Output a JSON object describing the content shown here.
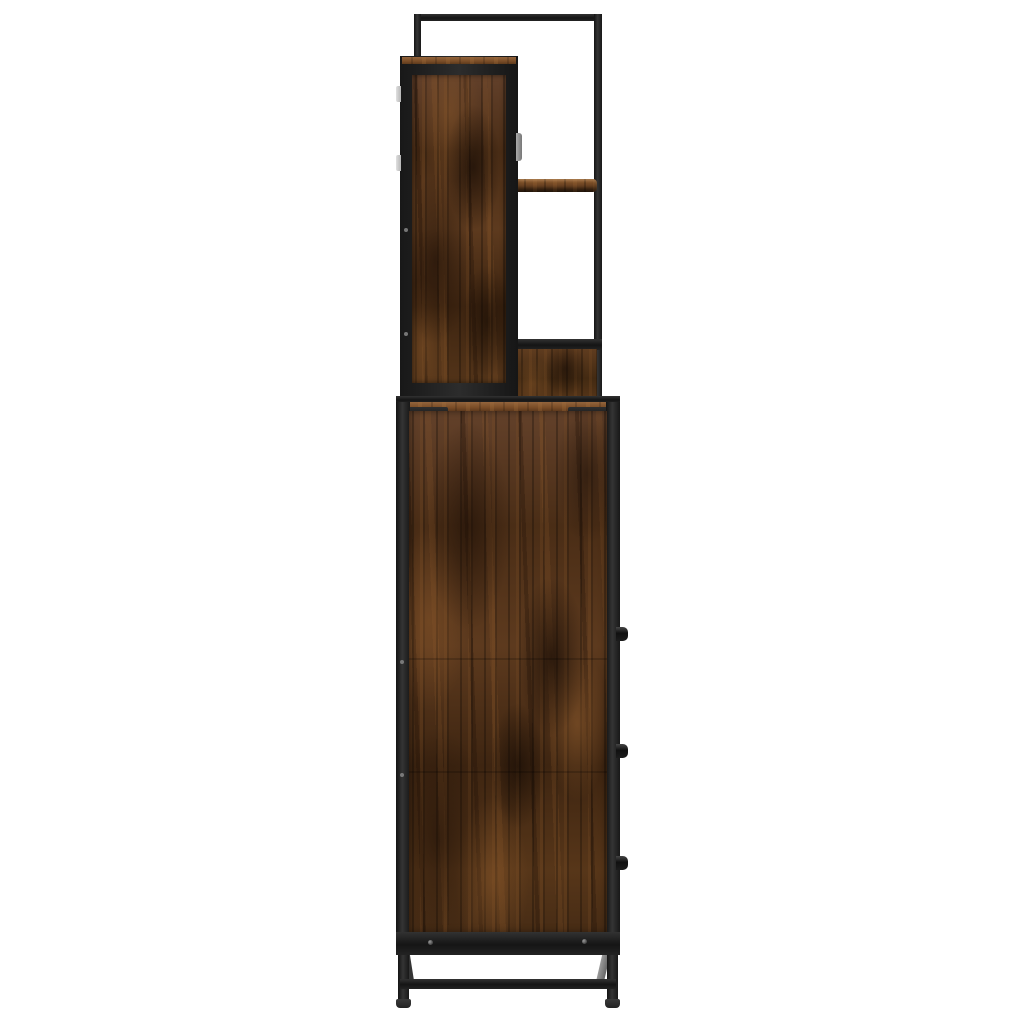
{
  "scene": {
    "kind": "product-photo",
    "subject": "Industrial-style bathroom furniture set shown in side profile: a wall cabinet with two open shelves mounted above a tall base cabinet on steel legs",
    "background_color": "#ffffff",
    "material": "smoked-oak wood panels with black powder-coated steel frame"
  },
  "palette": {
    "background": "#ffffff",
    "metal_dark": "#151515",
    "metal_mid": "#2e2e2e",
    "metal_highlight": "#3a3a3a",
    "wood_darkest": "#241307",
    "wood_dark": "#3a2110",
    "wood_mid": "#5d3a1e",
    "wood_light": "#8a5c30",
    "wood_top_surface": "#93643c",
    "rivet": "#9a9a9a",
    "hinge": "#d5d5d5",
    "door_handle": "#8e8e8e",
    "rear_leg_gray": "#8f8f8f"
  },
  "structure": {
    "top_frame": {
      "bars": [
        "top-bar",
        "left-post",
        "right-post"
      ]
    },
    "wall_cabinet": {
      "hinges": 2,
      "door_handle": 1,
      "open_shelves": 2
    },
    "base_cabinet": {
      "knobs": 3,
      "corner_brackets": 2,
      "rivets_top": 4,
      "rivets_bottom": 2,
      "panel_seams": 2
    },
    "base_frame": {
      "front_legs": 2,
      "rear_legs_visible": 2,
      "cross_brace": 1,
      "feet": 2
    }
  }
}
